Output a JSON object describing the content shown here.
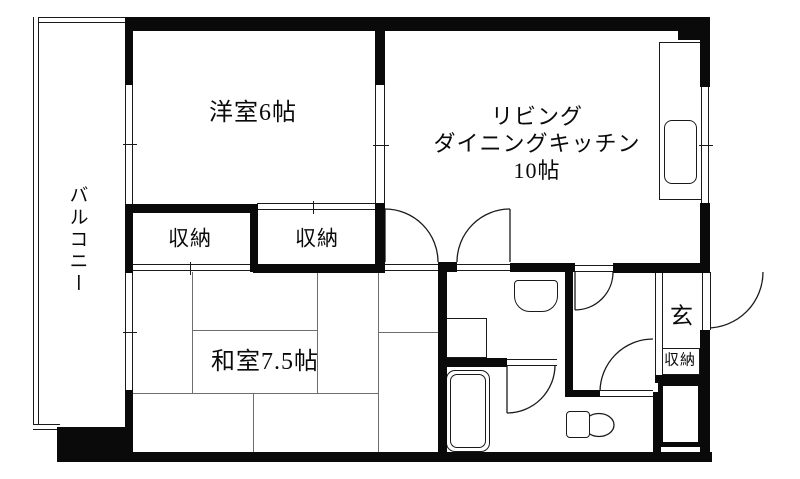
{
  "document": {
    "kind": "apartment-floor-plan",
    "wall_color": "#0a0a0a",
    "line_color": "#1a1a1a",
    "bg_color": "#ffffff"
  },
  "plan": {
    "canvas": {
      "w": 800,
      "h": 479
    },
    "walls": [
      {
        "name": "wall-top",
        "x": 127,
        "y": 17,
        "w": 583,
        "h": 14
      },
      {
        "name": "wall-top-right-corner",
        "x": 678,
        "y": 17,
        "w": 32,
        "h": 23
      },
      {
        "name": "wall-right-upper",
        "x": 700,
        "y": 31,
        "w": 10,
        "h": 56
      },
      {
        "name": "wall-right-middle",
        "x": 700,
        "y": 203,
        "w": 10,
        "h": 70
      },
      {
        "name": "wall-right-lower",
        "x": 700,
        "y": 330,
        "w": 10,
        "h": 125
      },
      {
        "name": "wall-bottom",
        "x": 57,
        "y": 452,
        "w": 655,
        "h": 10
      },
      {
        "name": "wall-bottom-left-corner",
        "x": 57,
        "y": 427,
        "w": 76,
        "h": 30
      },
      {
        "name": "wall-left-upper",
        "x": 125,
        "y": 17,
        "w": 8,
        "h": 68
      },
      {
        "name": "wall-left-middle",
        "x": 125,
        "y": 204,
        "w": 8,
        "h": 69
      },
      {
        "name": "wall-left-lower",
        "x": 125,
        "y": 390,
        "w": 8,
        "h": 40
      },
      {
        "name": "wall-western-room-bottom",
        "x": 125,
        "y": 204,
        "w": 132,
        "h": 9
      },
      {
        "name": "wall-closet-divider",
        "x": 250,
        "y": 204,
        "w": 8,
        "h": 68
      },
      {
        "name": "wall-room-divider-upper",
        "x": 375,
        "y": 17,
        "w": 10,
        "h": 68
      },
      {
        "name": "wall-room-divider-lower",
        "x": 375,
        "y": 203,
        "w": 10,
        "h": 69
      },
      {
        "name": "wall-closet-right-bottom",
        "x": 253,
        "y": 264,
        "w": 132,
        "h": 9
      },
      {
        "name": "wall-french-door-post",
        "x": 438,
        "y": 262,
        "w": 19,
        "h": 10
      },
      {
        "name": "wall-ldk-bottom-a",
        "x": 510,
        "y": 263,
        "w": 65,
        "h": 9
      },
      {
        "name": "wall-ldk-bottom-b",
        "x": 613,
        "y": 263,
        "w": 97,
        "h": 10
      },
      {
        "name": "wall-washroom-left",
        "x": 438,
        "y": 272,
        "w": 9,
        "h": 183
      },
      {
        "name": "wall-bath-top",
        "x": 438,
        "y": 358,
        "w": 69,
        "h": 9
      },
      {
        "name": "wall-washroom-hall",
        "x": 565,
        "y": 272,
        "w": 8,
        "h": 125
      },
      {
        "name": "wall-toilet-top",
        "x": 565,
        "y": 390,
        "w": 35,
        "h": 7
      },
      {
        "name": "wall-toilet-right",
        "x": 653,
        "y": 392,
        "w": 8,
        "h": 61
      },
      {
        "name": "wall-entrance-bottom",
        "x": 655,
        "y": 375,
        "w": 55,
        "h": 8
      }
    ],
    "double_lines": [
      {
        "name": "window-western-room",
        "x": 125,
        "y": 85,
        "w": 8,
        "h": 119,
        "dir": "v",
        "tick": 59
      },
      {
        "name": "window-japanese-room",
        "x": 125,
        "y": 272,
        "w": 8,
        "h": 118,
        "dir": "v",
        "tick": 60
      },
      {
        "name": "sliding-partition-western-ldk",
        "x": 375,
        "y": 85,
        "w": 10,
        "h": 118,
        "dir": "v",
        "tick": 60
      },
      {
        "name": "window-ldk",
        "x": 701,
        "y": 87,
        "w": 8,
        "h": 116,
        "dir": "v",
        "tick": 58
      },
      {
        "name": "closet-right-sliding-door",
        "x": 257,
        "y": 203,
        "w": 118,
        "h": 7,
        "dir": "h",
        "tick": 56
      },
      {
        "name": "closet-left-sliding-door",
        "x": 129,
        "y": 264,
        "w": 121,
        "h": 7,
        "dir": "h",
        "tick": 61
      },
      {
        "name": "opening-ldk-japanese-room",
        "x": 385,
        "y": 264,
        "w": 53,
        "h": 7,
        "dir": "h"
      },
      {
        "name": "opening-ldk-washroom",
        "x": 457,
        "y": 264,
        "w": 53,
        "h": 7,
        "dir": "h"
      },
      {
        "name": "opening-ldk-hallway",
        "x": 575,
        "y": 265,
        "w": 38,
        "h": 7,
        "dir": "h"
      },
      {
        "name": "opening-bathroom-door",
        "x": 507,
        "y": 359,
        "w": 50,
        "h": 7,
        "dir": "h"
      },
      {
        "name": "opening-toilet-door",
        "x": 600,
        "y": 390,
        "w": 53,
        "h": 7,
        "dir": "h"
      },
      {
        "name": "front-door-leaf",
        "x": 702,
        "y": 272,
        "w": 9,
        "h": 58,
        "dir": "v"
      },
      {
        "name": "entrance-step-edge",
        "x": 655,
        "y": 272,
        "w": 8,
        "h": 104,
        "dir": "v"
      },
      {
        "name": "balcony-rail-top",
        "x": 33,
        "y": 17,
        "w": 94,
        "h": 6,
        "dir": "h"
      },
      {
        "name": "balcony-rail-left",
        "x": 33,
        "y": 17,
        "w": 6,
        "h": 413,
        "dir": "v"
      },
      {
        "name": "balcony-rail-bottom",
        "x": 33,
        "y": 424,
        "w": 27,
        "h": 6,
        "dir": "h"
      }
    ],
    "outlines": [
      {
        "name": "kitchen-counter",
        "x": 659,
        "y": 42,
        "w": 43,
        "h": 158,
        "r": "0"
      },
      {
        "name": "kitchen-sink",
        "x": 664,
        "y": 120,
        "w": 33,
        "h": 64,
        "r": "8px"
      },
      {
        "name": "washing-machine-pan",
        "x": 443,
        "y": 318,
        "w": 44,
        "h": 40,
        "r": "0"
      },
      {
        "name": "bathtub-outer",
        "x": 446,
        "y": 370,
        "w": 44,
        "h": 82,
        "r": "9px"
      },
      {
        "name": "bathtub-inner",
        "x": 450,
        "y": 374,
        "w": 36,
        "h": 74,
        "r": "7px"
      },
      {
        "name": "entrance-storage-box",
        "x": 660,
        "y": 348,
        "w": 40,
        "h": 27,
        "r": "0"
      },
      {
        "name": "toilet-tank",
        "x": 566,
        "y": 411,
        "w": 24,
        "h": 27,
        "r": "4px"
      },
      {
        "name": "washbasin-unit",
        "x": 514,
        "y": 280,
        "w": 44,
        "h": 32,
        "r": "4px 4px 16px 16px"
      }
    ],
    "x_box": {
      "name": "pipe-space-box",
      "x": 658,
      "y": 381,
      "w": 45,
      "h": 66,
      "border": 5
    },
    "tatami_lines": [
      {
        "x": 192,
        "y": 272,
        "w": 1,
        "h": 121
      },
      {
        "x": 317,
        "y": 272,
        "w": 1,
        "h": 121
      },
      {
        "x": 378,
        "y": 272,
        "w": 1,
        "h": 180
      },
      {
        "x": 253,
        "y": 393,
        "w": 1,
        "h": 59
      },
      {
        "x": 130,
        "y": 393,
        "w": 248,
        "h": 1
      },
      {
        "x": 192,
        "y": 330,
        "w": 125,
        "h": 1
      },
      {
        "x": 378,
        "y": 332,
        "w": 60,
        "h": 1
      }
    ],
    "arcs": [
      {
        "name": "door-arc-french-left",
        "d": "M 385 209 A 53 53 0 0 1 438 262"
      },
      {
        "name": "door-arc-french-right",
        "d": "M 510 209 A 53 53 0 0 0 457 262"
      },
      {
        "name": "door-arc-hallway",
        "d": "M 575 310 A 38 38 0 0 0 613 272"
      },
      {
        "name": "door-arc-toilet",
        "d": "M 600 392 A 53 53 0 0 1 653 339"
      },
      {
        "name": "door-arc-bathroom",
        "d": "M 507 413 A 48 48 0 0 0 555 365"
      },
      {
        "name": "door-arc-front-entrance",
        "d": "M 707 328 A 56 56 0 0 0 763 272"
      }
    ],
    "leaf_lines": [
      {
        "name": "door-leaf-french-left",
        "x1": 385,
        "y1": 209,
        "x2": 385,
        "y2": 262
      },
      {
        "name": "door-leaf-french-right",
        "x1": 510,
        "y1": 209,
        "x2": 510,
        "y2": 262
      },
      {
        "name": "door-leaf-hallway",
        "x1": 575,
        "y1": 272,
        "x2": 575,
        "y2": 310
      },
      {
        "name": "door-leaf-bathroom",
        "x1": 507,
        "y1": 365,
        "x2": 507,
        "y2": 413
      },
      {
        "name": "pipe-space-x-line-1",
        "x1": 663,
        "y1": 386,
        "x2": 698,
        "y2": 442
      },
      {
        "name": "pipe-space-x-line-2",
        "x1": 698,
        "y1": 386,
        "x2": 663,
        "y2": 442
      },
      {
        "name": "toilet-tank-line",
        "x1": 584,
        "y1": 414,
        "x2": 584,
        "y2": 436
      }
    ],
    "svg_shapes": [
      {
        "name": "washbasin-bowl",
        "type": "ellipse",
        "cx": 535.5,
        "cy": 296.5,
        "rx": 16.5,
        "ry": 11.5
      },
      {
        "name": "toilet-bowl",
        "type": "ellipse",
        "cx": 599,
        "cy": 425,
        "rx": 15,
        "ry": 11.5
      },
      {
        "name": "washer-pan-drain",
        "type": "circle",
        "cx": 452,
        "cy": 340,
        "r": 5
      }
    ],
    "labels": [
      {
        "name": "balcony-label",
        "text": "バルコニー",
        "x": 77,
        "y": 240,
        "size": 19,
        "vertical": true
      },
      {
        "name": "western-room-label",
        "text": "洋室6帖",
        "x": 253,
        "y": 113,
        "size": 24
      },
      {
        "name": "ldk-label-line1",
        "text": "リビング",
        "x": 537,
        "y": 117,
        "size": 22
      },
      {
        "name": "ldk-label-line2",
        "text": "ダイニングキッチン",
        "x": 537,
        "y": 144,
        "size": 22
      },
      {
        "name": "ldk-label-line3",
        "text": "10帖",
        "x": 537,
        "y": 171,
        "size": 22
      },
      {
        "name": "closet-left-label",
        "text": "収納",
        "x": 190,
        "y": 239,
        "size": 21
      },
      {
        "name": "closet-right-label",
        "text": "収納",
        "x": 317,
        "y": 239,
        "size": 21
      },
      {
        "name": "japanese-room-label",
        "text": "和室7.5帖",
        "x": 265,
        "y": 362,
        "size": 24
      },
      {
        "name": "entrance-label",
        "text": "玄",
        "x": 682,
        "y": 316,
        "size": 23
      },
      {
        "name": "entrance-storage-label",
        "text": "収納",
        "x": 680,
        "y": 361,
        "size": 15
      }
    ]
  }
}
